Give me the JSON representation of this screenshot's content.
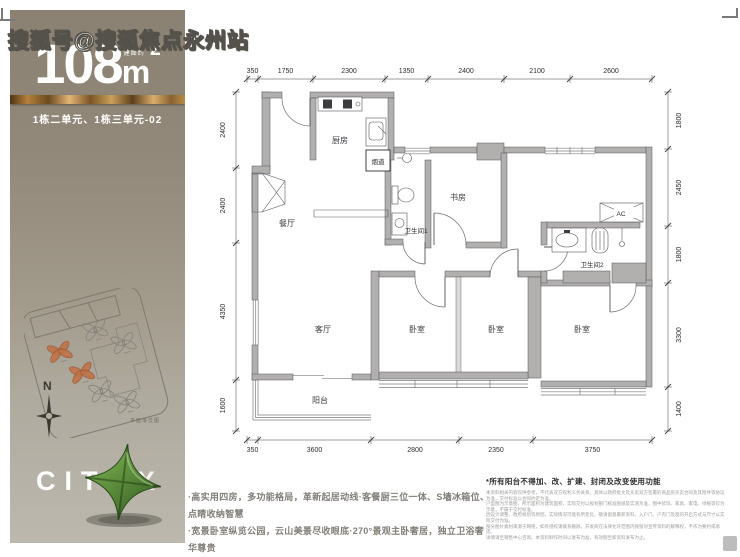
{
  "watermark": "搜狐号@搜狐焦点永州站",
  "sidebar": {
    "area_prefix": "建面约",
    "area_value": "108",
    "area_unit": "m",
    "area_exponent": "2",
    "unit_label": "1栋二单元、1栋三单元-02",
    "compass_label": "N",
    "siteplan_caption": "平面落位图",
    "brand_text": "CITY",
    "brand_x": "X",
    "colors": {
      "accent_gold": "#c9944e",
      "brand_green": "#5d8f3c",
      "highlight_orange": "#c0734a",
      "sidebar_top": "#8a8172",
      "sidebar_bottom": "#bcb8ae"
    },
    "siteplan_buildings": [
      {
        "x": 40,
        "y": 54,
        "highlight": true
      },
      {
        "x": 80,
        "y": 42,
        "highlight": false
      },
      {
        "x": 104,
        "y": 62,
        "highlight": false
      },
      {
        "x": 56,
        "y": 80,
        "highlight": true
      },
      {
        "x": 70,
        "y": 103,
        "highlight": false
      },
      {
        "x": 92,
        "y": 120,
        "highlight": false
      }
    ]
  },
  "floorplan": {
    "labels": {
      "kitchen": "厨房",
      "dining": "餐厅",
      "living": "客厅",
      "study": "书房",
      "bath1": "卫生间1",
      "bath2": "卫生间2",
      "bedroom": "卧室",
      "balcony": "阳台",
      "flue": "烟道",
      "ac": "AC"
    },
    "dims_top": [
      "350",
      "1750",
      "2300",
      "1350",
      "2400",
      "2100",
      "2600"
    ],
    "dims_bottom": [
      "350",
      "3600",
      "2800",
      "2350",
      "3750"
    ],
    "dims_left": [
      "2400",
      "2400",
      "4350",
      "1600"
    ],
    "dims_right": [
      "1800",
      "2450",
      "1800",
      "3300",
      "1400"
    ]
  },
  "footer": {
    "bullet1": "·高实用四房，多功能格局，革新起居动线·客餐厨三位一体、S墙冰箱位、点睛收纳智慧",
    "bullet2": "·宽景卧室纵览公园，云山美景尽收眼底·270°景观主卧奢居，独立卫浴奢华尊贵",
    "disclaimer_title": "*所有阳台不得加、改、扩建、封闭及改变使用功能",
    "fine_print_lines": [
      "本资料相关内容仅供参考，不代表双方权利义务关系，具体以政府批文及买卖双方签署的商品房买卖合同及其附件等协议为准，交付标准以合同约定为准。",
      "户型图为示意图，所示面积为建筑面积，实际交付以规划部门核准图纸及实测为准，图中装饰、家具、家电、绿植等仅为示意，不属于交付标准。",
      "因设计调整、政府规划等原因，实际情况可能有所变化，敬请留意最新资料。入户门、户内门及窗的开启方式与尺寸以实际交付为准。",
      "部分图片素材来源于网络，如有侵权请联系删除，开发商在法律允许范围内保留对宣传资料的解释权，不作为要约或承诺。",
      "详情请至销售中心咨询。本资料制作时间以发布为准，有效期至新资料发布为止。"
    ]
  }
}
